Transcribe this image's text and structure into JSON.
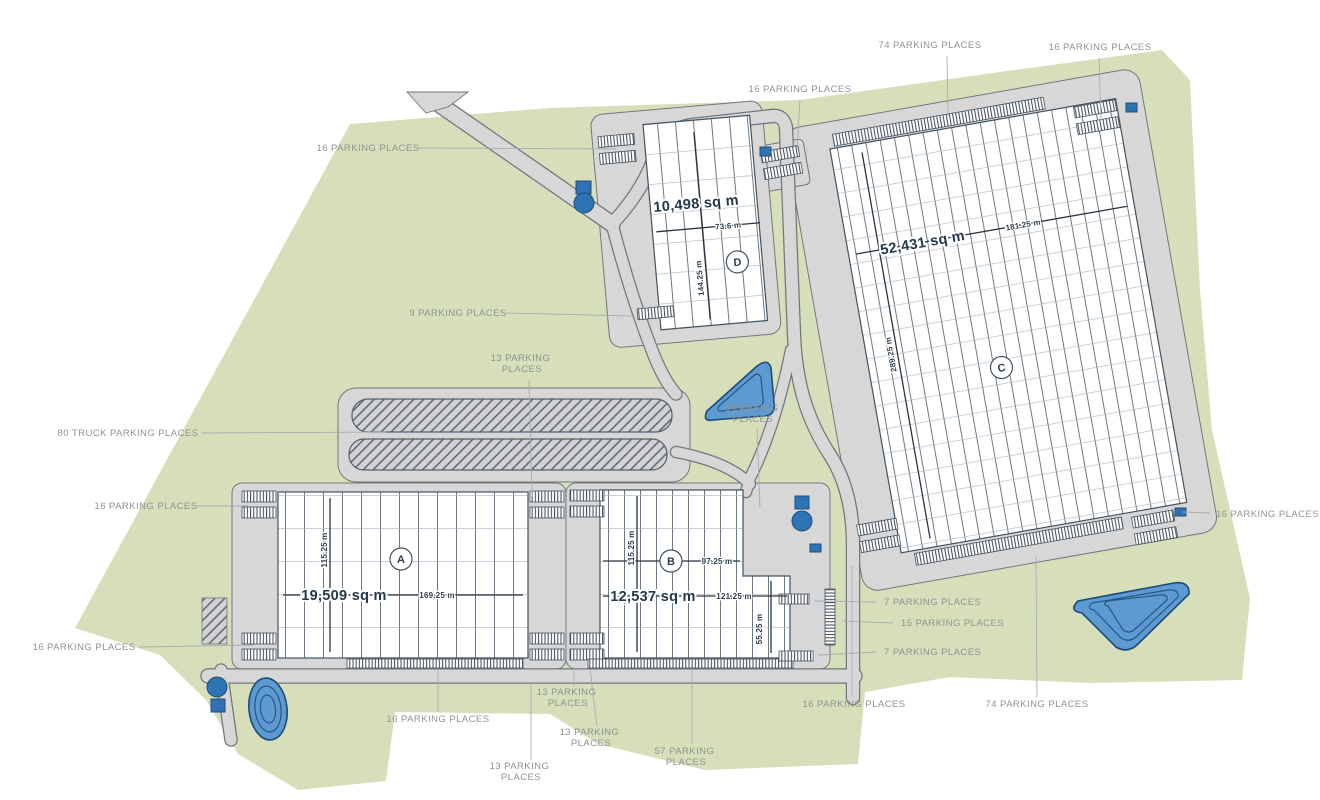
{
  "colors": {
    "site": "#d6dfba",
    "road": "#d7d7d7",
    "road_edge": "#70777e",
    "outline": "#44525e",
    "label_text": "#8d9390",
    "dim_text": "#2c3e50",
    "area_text": "#24384c",
    "pond_fill": "#5d9ad2",
    "pond_edge": "#1c4a7a",
    "marker_blue": "#2e74b5"
  },
  "buildings": {
    "a": {
      "letter": "A",
      "area": "19,509 sq m",
      "length": "169.25 m",
      "depth": "115.25 m"
    },
    "b": {
      "letter": "B",
      "area": "12,537 sq m",
      "length": "121.25 m",
      "depth": "115.25 m",
      "mid_length": "97.25 m",
      "wing_depth": "55.25 m"
    },
    "c": {
      "letter": "C",
      "area": "52,431 sq m",
      "length": "181.25 m",
      "depth": "289.25 m"
    },
    "d": {
      "letter": "D",
      "area": "10,498 sq m",
      "length": "73.6 m",
      "depth": "144.25 m"
    }
  },
  "parking": {
    "p74_top": "74 PARKING PLACES",
    "p16_top_right": "16 PARKING PLACES",
    "p16_top_mid": "16 PARKING PLACES",
    "p16_d_left": "16 PARKING PLACES",
    "p9": "9 PARKING PLACES",
    "p13_ab_top": {
      "l1": "13 PARKING",
      "l2": "PLACES"
    },
    "p80_truck": "80 TRUCK PARKING PLACES",
    "p16_a_left": "16 PARKING PLACES",
    "p6": {
      "l1": "6 PARKING",
      "l2": "PLACES"
    },
    "p16_a_bottom_left": "16 PARKING PLACES",
    "p16_a_bottom": "16 PARKING PLACES",
    "p13_mid_1": {
      "l1": "13 PARKING",
      "l2": "PLACES"
    },
    "p13_mid_2": {
      "l1": "13 PARKING",
      "l2": "PLACES"
    },
    "p13_bottom": {
      "l1": "13 PARKING",
      "l2": "PLACES"
    },
    "p57": {
      "l1": "57 PARKING",
      "l2": "PLACES"
    },
    "p7_top": "7 PARKING PLACES",
    "p15": "15 PARKING PLACES",
    "p7_bottom": "7 PARKING PLACES",
    "p16_c_left": "16 PARKING PLACES",
    "p74_bottom": "74 PARKING PLACES",
    "p16_c_right": "16 PARKING PLACES"
  }
}
